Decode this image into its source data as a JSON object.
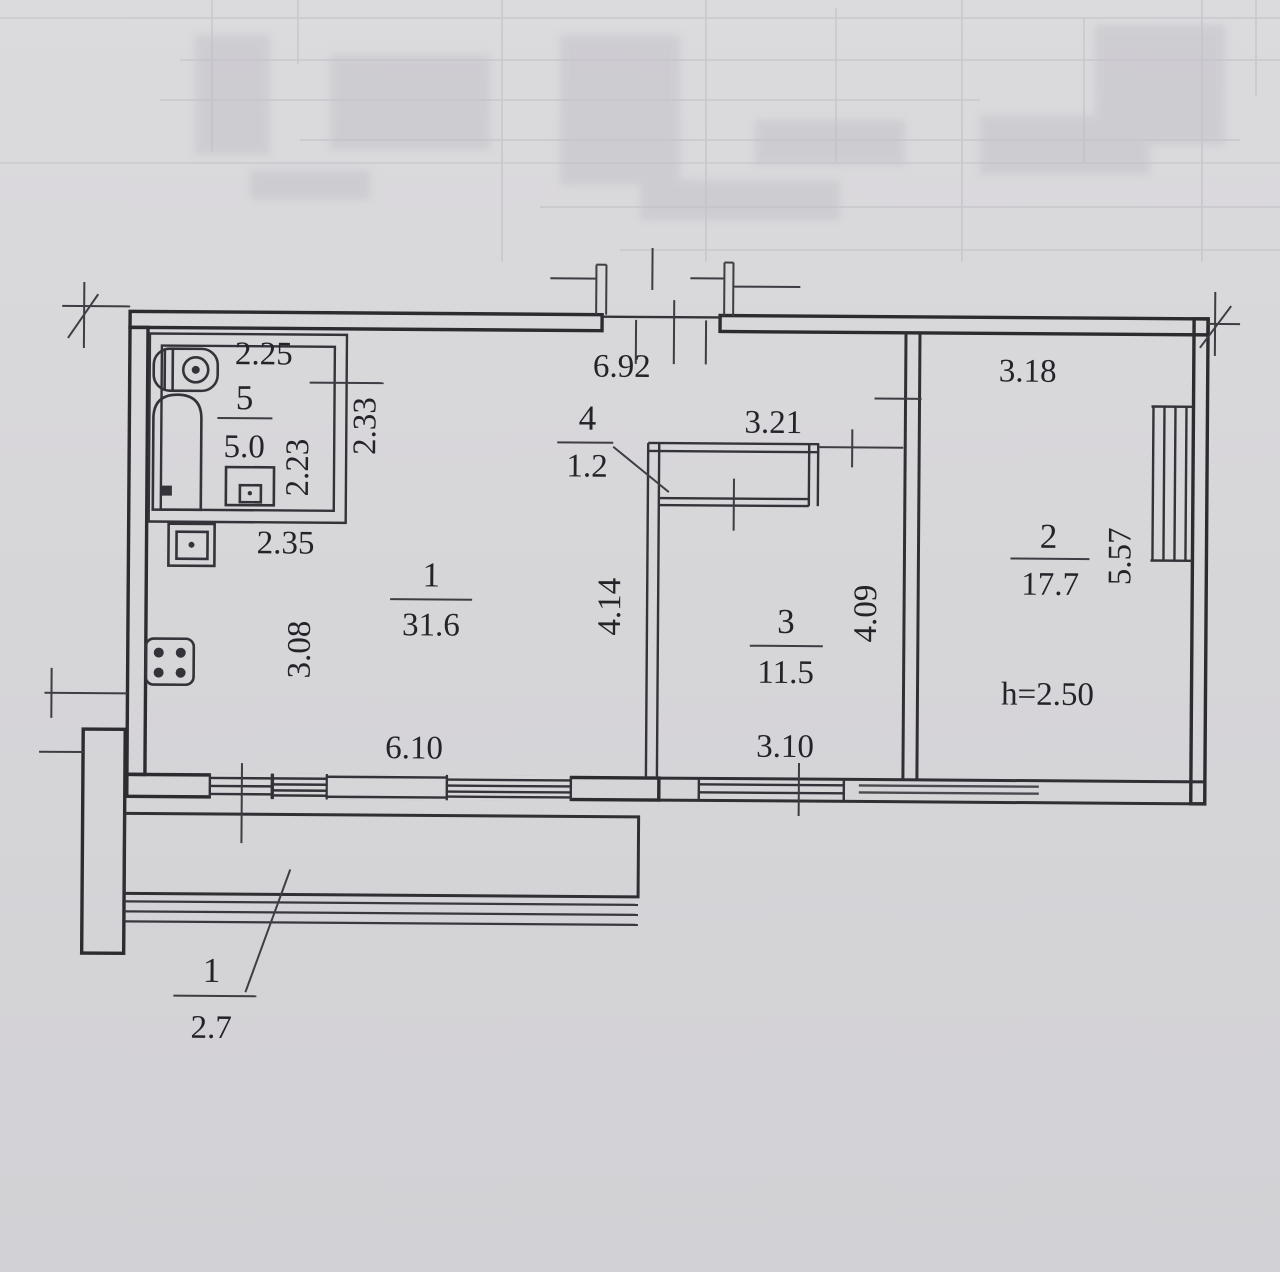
{
  "palette": {
    "paper": "#d6d5d8",
    "ink": "#2c2b2f",
    "faint_grid": "#b4b3bc"
  },
  "plan": {
    "ceiling_height_label": "h=2.50",
    "rooms": [
      {
        "key": "room-1",
        "number": "1",
        "area": "31.6"
      },
      {
        "key": "room-2",
        "number": "2",
        "area": "17.7"
      },
      {
        "key": "room-3",
        "number": "3",
        "area": "11.5"
      },
      {
        "key": "room-4-closet",
        "number": "4",
        "area": "1.2"
      },
      {
        "key": "room-5-bathroom",
        "number": "5",
        "area": "5.0"
      },
      {
        "key": "balcony",
        "number": "1",
        "area": "2.7"
      }
    ],
    "dimensions": {
      "bathroom_width_top": "2.25",
      "bathroom_depth_inner": "2.23",
      "bathroom_depth_outer": "2.33",
      "below_bathroom_width": "2.35",
      "corridor_width_top": "6.92",
      "closet_bay_width": "3.21",
      "room2_width_top": "3.18",
      "room2_depth_right": "5.57",
      "room1_depth_right": "4.14",
      "room3_depth_right": "4.09",
      "room1_depth_left": "3.08",
      "room1_width_bottom": "6.10",
      "room3_width_bottom": "3.10"
    },
    "fixture_icons": [
      "bathtub-icon",
      "washbasin-icon",
      "toilet-icon",
      "kitchen-sink-icon",
      "stove-icon"
    ]
  }
}
